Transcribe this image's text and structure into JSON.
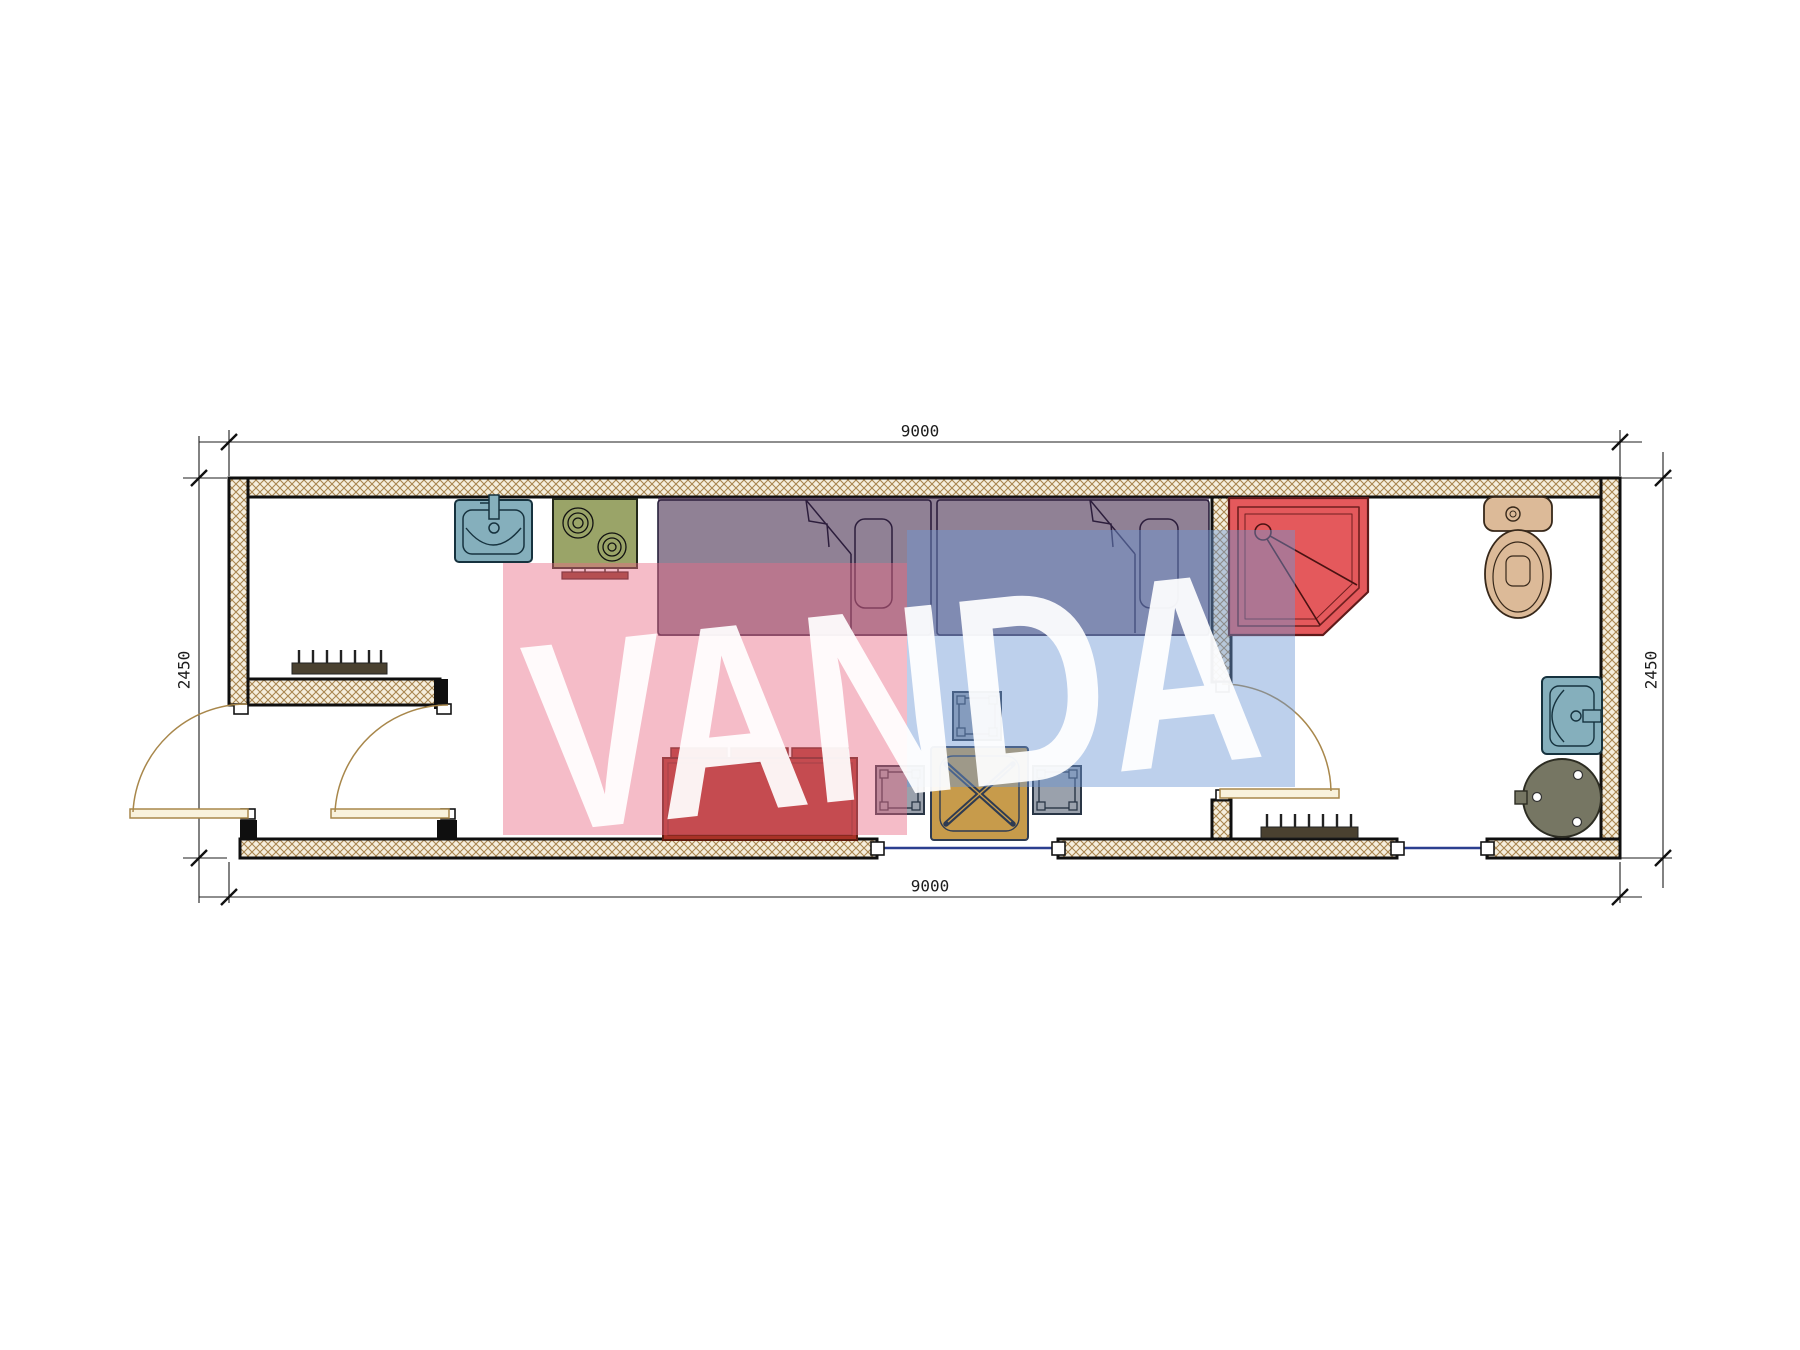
{
  "watermark": {
    "text": "VANDA",
    "pink_color": "#e86a86",
    "blue_color": "#6c96d4",
    "text_color": "#ffffff"
  },
  "dimensions": {
    "top": "9000",
    "bottom": "9000",
    "left": "2450",
    "right": "2450"
  },
  "colors": {
    "wall_fill": "#f5eedd",
    "wall_hatch_line": "#a8854f",
    "wall_outline": "#0f0f0f",
    "window_glass": "#2b3f8f",
    "door": "#a8874b",
    "shower": "#e4595c",
    "toilet": "#dcba98",
    "sink": "#85afbc",
    "stove": "#9aa468",
    "sofa": "#a83226",
    "table": "#c79b4b",
    "chair": "#9aa1ac",
    "water_heater": "#767663",
    "radiator": "#4a4130",
    "bed_overlay": "rgba(52,25,62,0.55)"
  },
  "furniture_legend": {
    "items": [
      "kitchen-sink",
      "stove",
      "single-bed-1",
      "single-bed-2",
      "corner-shower",
      "toilet",
      "washbasin",
      "water-heater",
      "sofa",
      "dining-table",
      "stool",
      "radiator"
    ]
  }
}
